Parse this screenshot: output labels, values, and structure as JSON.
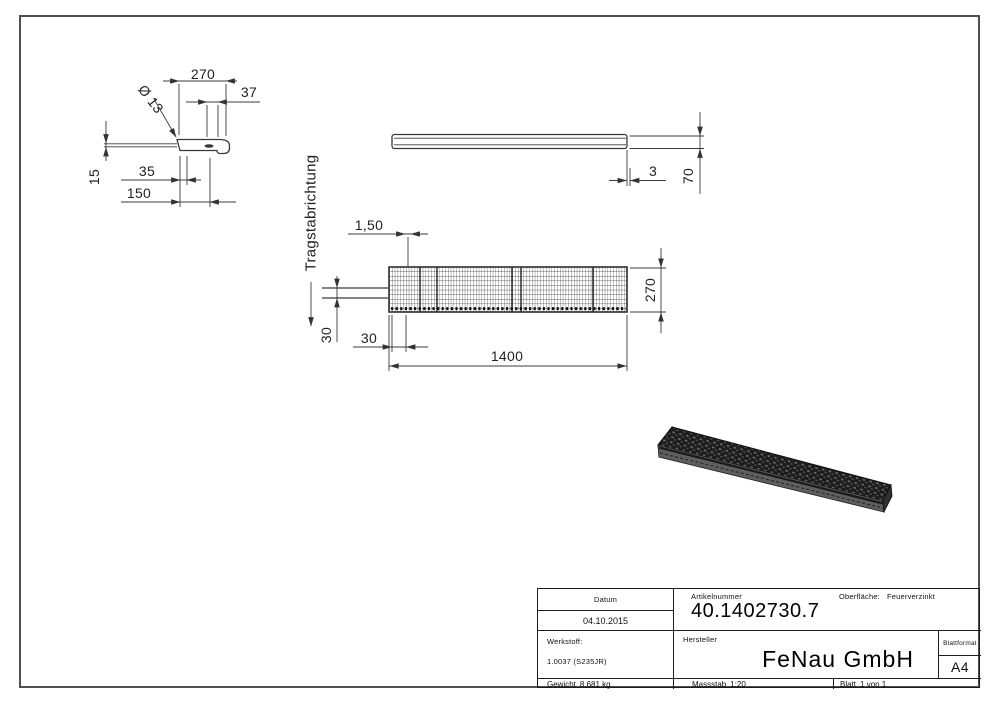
{
  "page": {
    "background": "#ffffff",
    "line_color": "#3b3b3b"
  },
  "views": {
    "detail_profile": {
      "dim_width": "270",
      "dim_hole_offset": "37",
      "dim_hole_diameter": "Ø 13",
      "dim_edge_to_hole": "35",
      "dim_thickness": "15",
      "dim_depth": "150"
    },
    "side": {
      "dim_end_thickness": "3",
      "dim_height": "70"
    },
    "plan": {
      "support_direction": "Tragstabrichtung",
      "dim_bar_thickness": "1,50",
      "dim_pitch_left": "30",
      "dim_pitch_bottom": "30",
      "dim_length": "1400",
      "dim_width": "270"
    }
  },
  "title_block": {
    "date_label": "Datum",
    "date_value": "04.10.2015",
    "article_label": "Artikelnummer",
    "article_value": "40.1402730.7",
    "surface_label": "Oberfläche:",
    "surface_value": "Feuerverzinkt",
    "material_label": "Werkstoff:",
    "material_value": "1.0037 (S235JR)",
    "manufacturer_label": "Hersteller",
    "manufacturer_value": "FeNau GmbH",
    "sheet_format_label": "Blattformat",
    "sheet_format_value": "A4",
    "weight_label": "Gewicht",
    "weight_value": "8.681 kg",
    "scale_label": "Massstab",
    "scale_value": "1:20",
    "sheet_label": "Blatt",
    "sheet_value": "1 von 1"
  }
}
